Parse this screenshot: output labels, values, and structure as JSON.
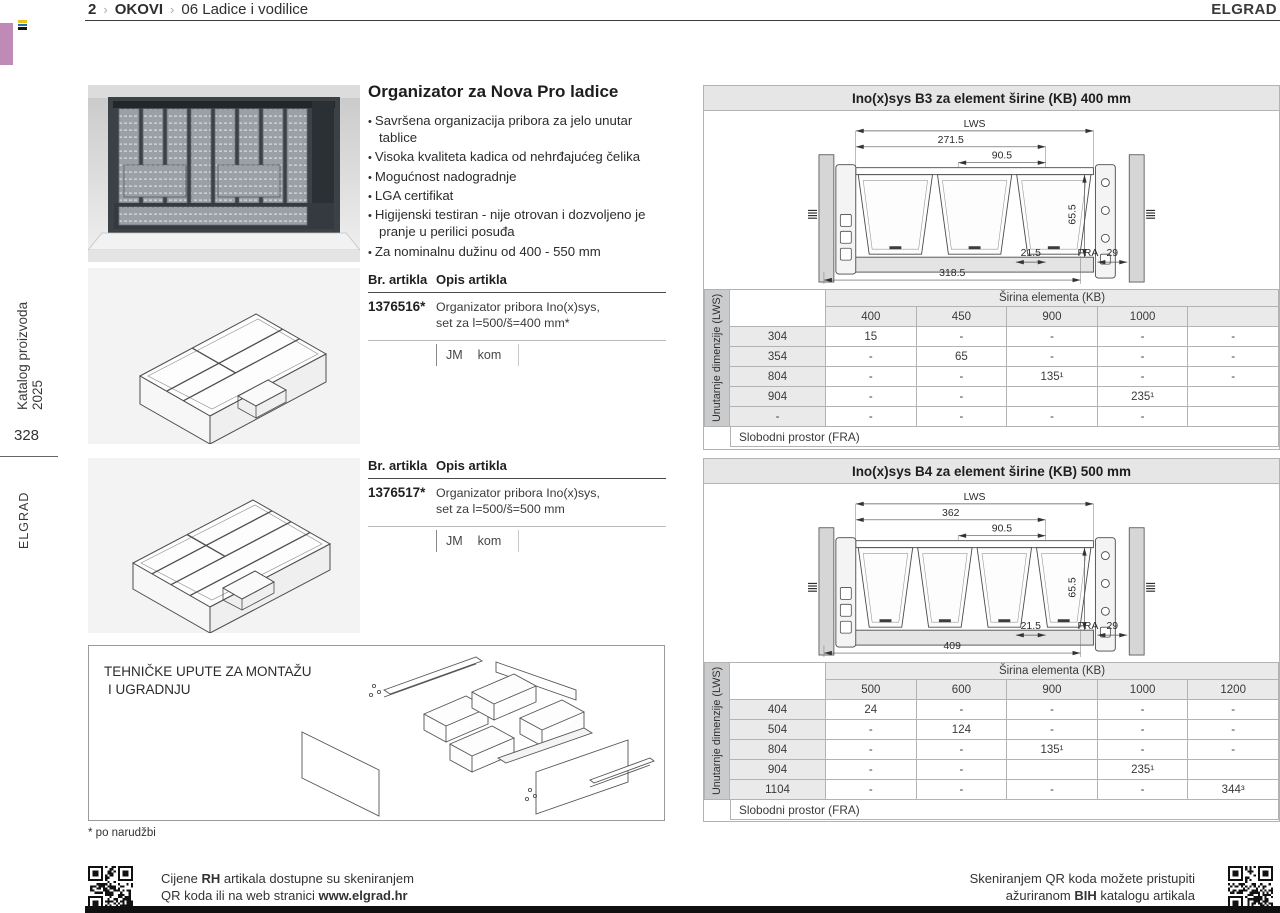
{
  "header": {
    "page_no": "2",
    "sep": "›",
    "section": "OKOVI",
    "chapter": "06",
    "chapter_title": "Ladice i vodilice",
    "brand": "ELGRAD"
  },
  "sidebar": {
    "catalog_title": "Katalog proizvoda 2025",
    "page_number": "328",
    "brand": "ELGRAD"
  },
  "product": {
    "title": "Organizator za Nova Pro ladice",
    "bullets": [
      "Savršena organizacija pribora za jelo unutar tablice",
      "Visoka kvaliteta kadica od nehrđajućeg čelika",
      "Mogućnost nadogradnje",
      "LGA certifikat",
      "Higijenski testiran - nije otrovan i dozvoljeno je pranje u perilici posuđa",
      "Za nominalnu dužinu od 400 - 550 mm"
    ],
    "articles": [
      {
        "col_no": "Br. artikla",
        "col_desc": "Opis artikla",
        "number": "1376516*",
        "desc": [
          "Organizator pribora Ino(x)sys,",
          "set za l=500/š=400 mm*"
        ],
        "unit_label": "JM",
        "unit_value": "kom"
      },
      {
        "col_no": "Br. artikla",
        "col_desc": "Opis artikla",
        "number": "1376517*",
        "desc": [
          "Organizator pribora Ino(x)sys,",
          "set za l=500/š=500 mm"
        ],
        "unit_label": "JM",
        "unit_value": "kom"
      }
    ],
    "tech_box": {
      "title_line1": "TEHNIČKE UPUTE ZA MONTAŽU",
      "title_line2": "I UGRADNJU"
    },
    "footnote": "* po narudžbi"
  },
  "panels": [
    {
      "title": "Ino(x)sys B3 za element širine (KB) 400 mm",
      "drawing": {
        "trays": 3,
        "labels": {
          "lws": "LWS",
          "inner": "271.5",
          "pitch": "90.5",
          "height": "65.5",
          "total": "318.5",
          "gap": "21.5",
          "fra": "FRA",
          "side": "29"
        }
      },
      "table": {
        "group_header": "Širina elementa (KB)",
        "side_label": "Unutarnje dimenzije (LWS)",
        "columns": [
          "400",
          "450",
          "900",
          "1000",
          ""
        ],
        "rows": [
          {
            "label": "304",
            "values": [
              "15",
              "-",
              "-",
              "-",
              "-"
            ]
          },
          {
            "label": "354",
            "values": [
              "-",
              "65",
              "-",
              "-",
              "-"
            ]
          },
          {
            "label": "804",
            "values": [
              "-",
              "-",
              "135¹",
              "-",
              "-"
            ]
          },
          {
            "label": "904",
            "values": [
              "-",
              "-",
              "",
              "235¹",
              ""
            ]
          },
          {
            "label": "-",
            "values": [
              "-",
              "-",
              "-",
              "-",
              ""
            ]
          }
        ],
        "footer": "Slobodni prostor (FRA)"
      }
    },
    {
      "title": "Ino(x)sys B4 za element širine (KB) 500 mm",
      "drawing": {
        "trays": 4,
        "labels": {
          "lws": "LWS",
          "inner": "362",
          "pitch": "90.5",
          "height": "65.5",
          "total": "409",
          "gap": "21.5",
          "fra": "FRA",
          "side": "29"
        }
      },
      "table": {
        "group_header": "Širina elementa (KB)",
        "side_label": "Unutarnje dimenzije (LWS)",
        "columns": [
          "500",
          "600",
          "900",
          "1000",
          "1200"
        ],
        "rows": [
          {
            "label": "404",
            "values": [
              "24",
              "-",
              "-",
              "-",
              "-"
            ]
          },
          {
            "label": "504",
            "values": [
              "-",
              "124",
              "-",
              "-",
              "-"
            ]
          },
          {
            "label": "804",
            "values": [
              "-",
              "-",
              "135¹",
              "-",
              "-"
            ]
          },
          {
            "label": "904",
            "values": [
              "-",
              "-",
              "",
              "235¹",
              ""
            ]
          },
          {
            "label": "1104",
            "values": [
              "-",
              "-",
              "-",
              "-",
              "344³"
            ]
          }
        ],
        "footer": "Slobodni prostor (FRA)"
      }
    }
  ],
  "footer": {
    "left": {
      "pre1": "Cijene ",
      "bold1": "RH",
      "post1": " artikala dostupne su skeniranjem",
      "pre2": "QR koda ili na web stranici ",
      "bold2": "www.elgrad.hr"
    },
    "right": {
      "line1": "Skeniranjem QR koda možete pristupiti",
      "pre2": "ažuriranom ",
      "bold2": "BIH",
      "post2": " katalogu artikala"
    }
  },
  "colors": {
    "accent_tab": "#c08ab6",
    "table_header_bg": "#eaeaea",
    "table_side_bg": "#c9cbcc",
    "panel_title_bg": "#e6e6e6"
  }
}
